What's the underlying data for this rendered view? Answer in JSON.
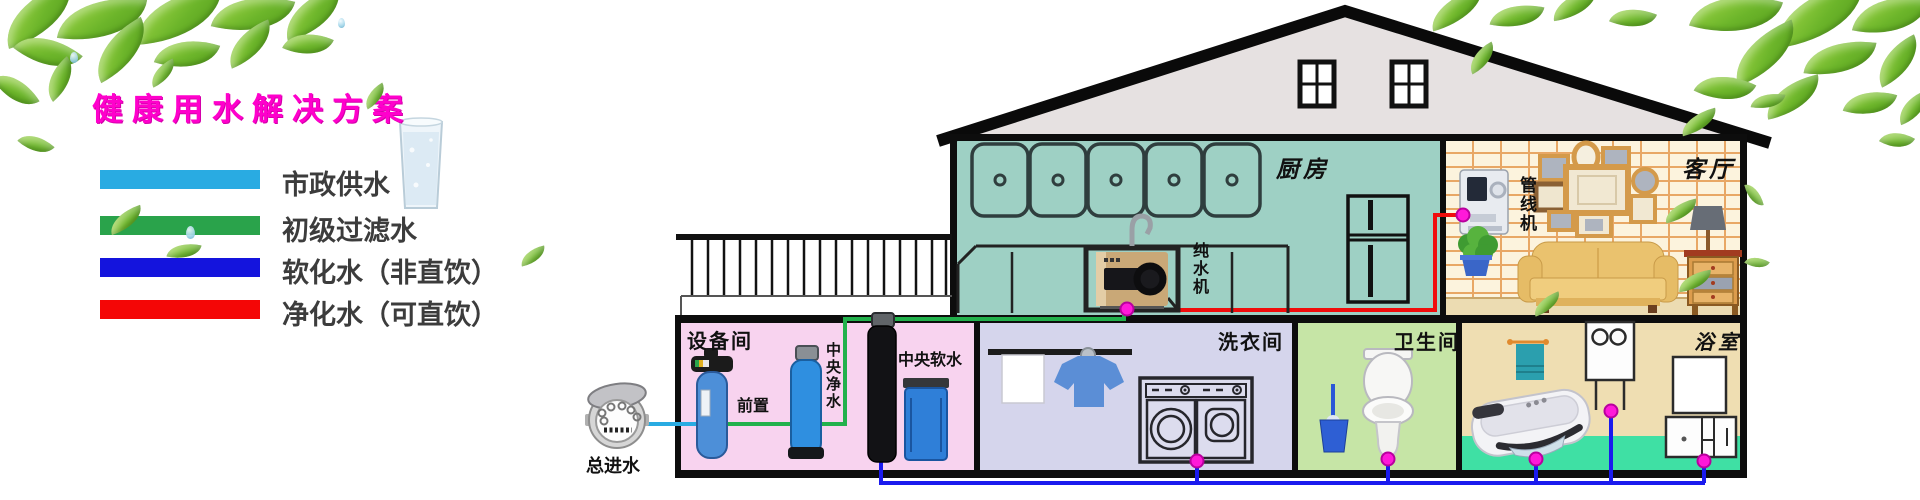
{
  "title": "健康用水解决方案",
  "title_color": "#ff00cc",
  "legend": {
    "items": [
      {
        "label": "市政供水",
        "color": "#29abe2"
      },
      {
        "label": "初级过滤水",
        "color": "#2aa34b"
      },
      {
        "label": "软化水（非直饮）",
        "color": "#1414dd"
      },
      {
        "label": "净化水（可直饮）",
        "color": "#f40606"
      }
    ]
  },
  "house": {
    "rooms": {
      "kitchen": {
        "label": "厨房"
      },
      "living": {
        "label": "客厅"
      },
      "equipment": {
        "label": "设备间"
      },
      "laundry": {
        "label": "洗衣间"
      },
      "toilet": {
        "label": "卫生间"
      },
      "bath": {
        "label": "浴室"
      }
    }
  },
  "devices": {
    "main_inlet": "总进水",
    "prefilter": "前置",
    "central_purifier": "中央净水",
    "central_softener": "中央软水",
    "pure_water_machine": "纯水机",
    "pipeline_machine": "管线机"
  },
  "pipes": {
    "municipal": "#29abe2",
    "filtered": "#22b14c",
    "softened": "#1a1aee",
    "purified": "#f10c0c",
    "joint_color": "#ff19d9",
    "joint_edge": "#b8009e"
  }
}
